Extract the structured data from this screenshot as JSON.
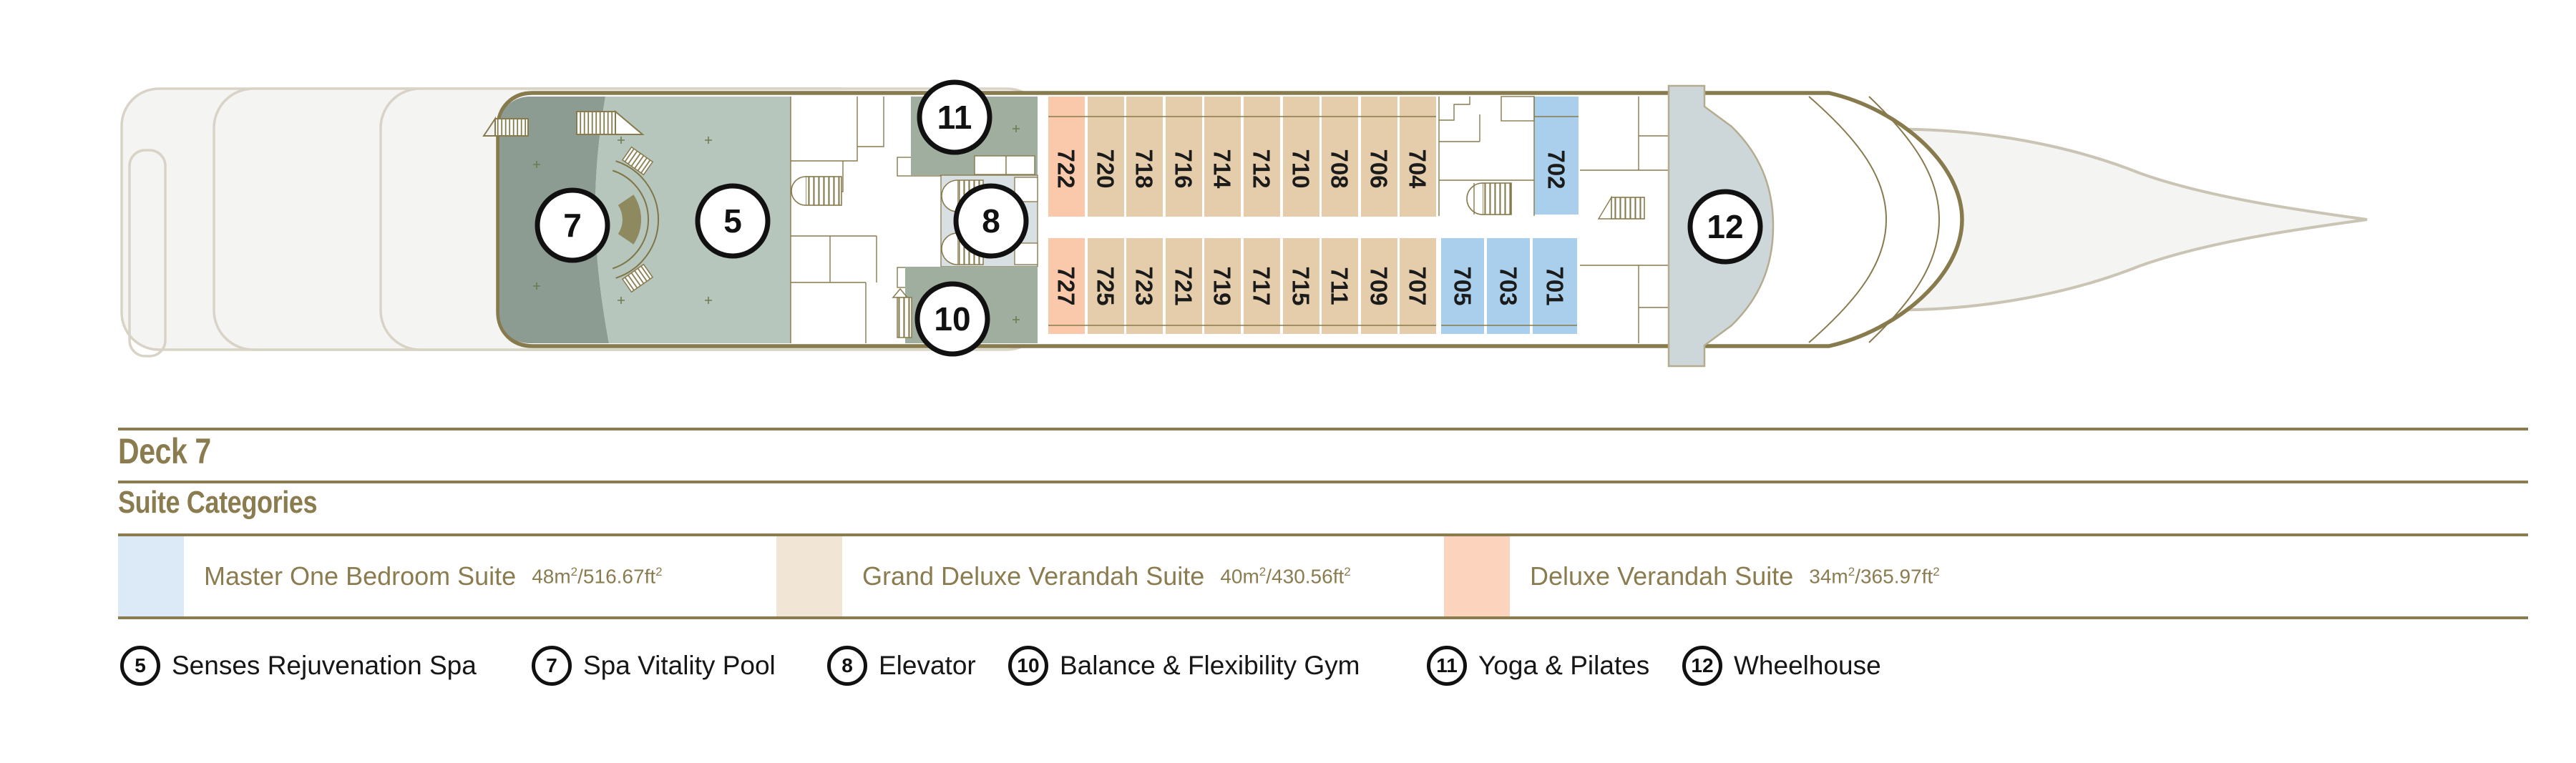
{
  "deck": {
    "title": "Deck 7"
  },
  "suiteCategories": {
    "title": "Suite Categories",
    "sup": "2",
    "slash": "/",
    "items": [
      {
        "name": "Master One Bedroom Suite",
        "m": "48m",
        "ft": "516.67ft",
        "swatch": "#dce9f6"
      },
      {
        "name": "Grand Deluxe Verandah Suite",
        "m": "40m",
        "ft": "430.56ft",
        "swatch": "#f1e5d5"
      },
      {
        "name": "Deluxe Verandah Suite",
        "m": "34m",
        "ft": "365.97ft",
        "swatch": "#fcd4be"
      }
    ]
  },
  "venues": [
    {
      "num": "5",
      "label": "Senses Rejuvenation Spa"
    },
    {
      "num": "7",
      "label": "Spa Vitality Pool"
    },
    {
      "num": "8",
      "label": "Elevator"
    },
    {
      "num": "10",
      "label": "Balance & Flexibility Gym"
    },
    {
      "num": "11",
      "label": "Yoga & Pilates"
    },
    {
      "num": "12",
      "label": "Wheelhouse"
    }
  ],
  "cabins": {
    "top": [
      {
        "number": "722"
      },
      {
        "number": "720"
      },
      {
        "number": "718"
      },
      {
        "number": "716"
      },
      {
        "number": "714"
      },
      {
        "number": "712"
      },
      {
        "number": "710"
      },
      {
        "number": "708"
      },
      {
        "number": "706"
      },
      {
        "number": "704"
      },
      {
        "number": "702"
      }
    ],
    "bottom": [
      {
        "number": "727"
      },
      {
        "number": "725"
      },
      {
        "number": "723"
      },
      {
        "number": "721"
      },
      {
        "number": "719"
      },
      {
        "number": "717"
      },
      {
        "number": "715"
      },
      {
        "number": "711"
      },
      {
        "number": "709"
      },
      {
        "number": "707"
      },
      {
        "number": "705"
      },
      {
        "number": "703"
      },
      {
        "number": "701"
      }
    ]
  },
  "colors": {
    "deckOutline": "#877a4d",
    "paleHull": "#f4f4f2",
    "masterSuite": "#aacfec",
    "grandDeluxe": "#e5cdab",
    "deluxeVerandah": "#fac9ac",
    "spaDark": "#8d9c92",
    "spaLight": "#b7c6bc",
    "gym": "#9fae9f",
    "elevatorArea": "#d8e0e3",
    "wheelhouse": "#cdd7da"
  }
}
